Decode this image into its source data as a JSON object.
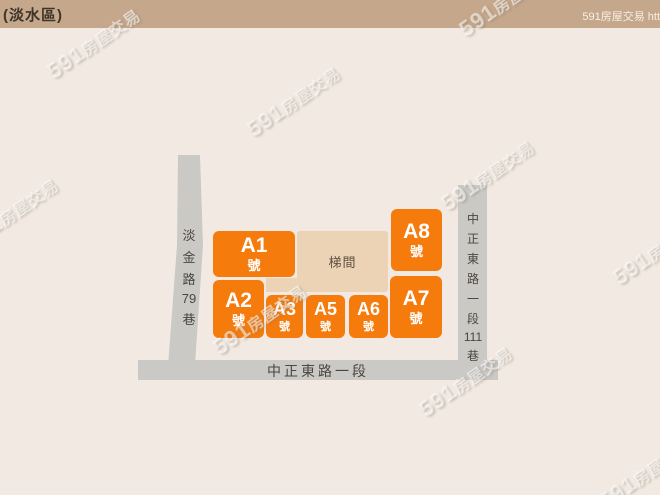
{
  "header": {
    "area": "(淡水區)",
    "site": "591房屋交易 htt"
  },
  "map": {
    "stairwell": {
      "label": "梯間"
    },
    "buildings": {
      "a1": {
        "label": "A1",
        "suffix": "號"
      },
      "a2": {
        "label": "A2",
        "suffix": "號"
      },
      "a3": {
        "label": "A3",
        "suffix": "號"
      },
      "a5": {
        "label": "A5",
        "suffix": "號"
      },
      "a6": {
        "label": "A6",
        "suffix": "號"
      },
      "a7": {
        "label": "A7",
        "suffix": "號"
      },
      "a8": {
        "label": "A8",
        "suffix": "號"
      }
    },
    "roads": {
      "left": {
        "name": "淡金路79巷",
        "chars": [
          "淡",
          "金",
          "路",
          "79",
          "巷"
        ]
      },
      "right": {
        "name": "中正東路一段111巷",
        "chars": [
          "中",
          "正",
          "東",
          "路",
          "一",
          "段",
          "111",
          "巷"
        ]
      },
      "bottom": {
        "name": "中正東路一段"
      }
    }
  },
  "watermark": {
    "num": "591",
    "cn": "房屋交易"
  },
  "colors": {
    "accent_orange": "#f57b0d",
    "stairwell_tan": "#edd3b5",
    "road_gray": "#cac9c6",
    "header_tan": "#c5a78b",
    "background": "#f2eae2",
    "building_text": "#ffffff"
  }
}
